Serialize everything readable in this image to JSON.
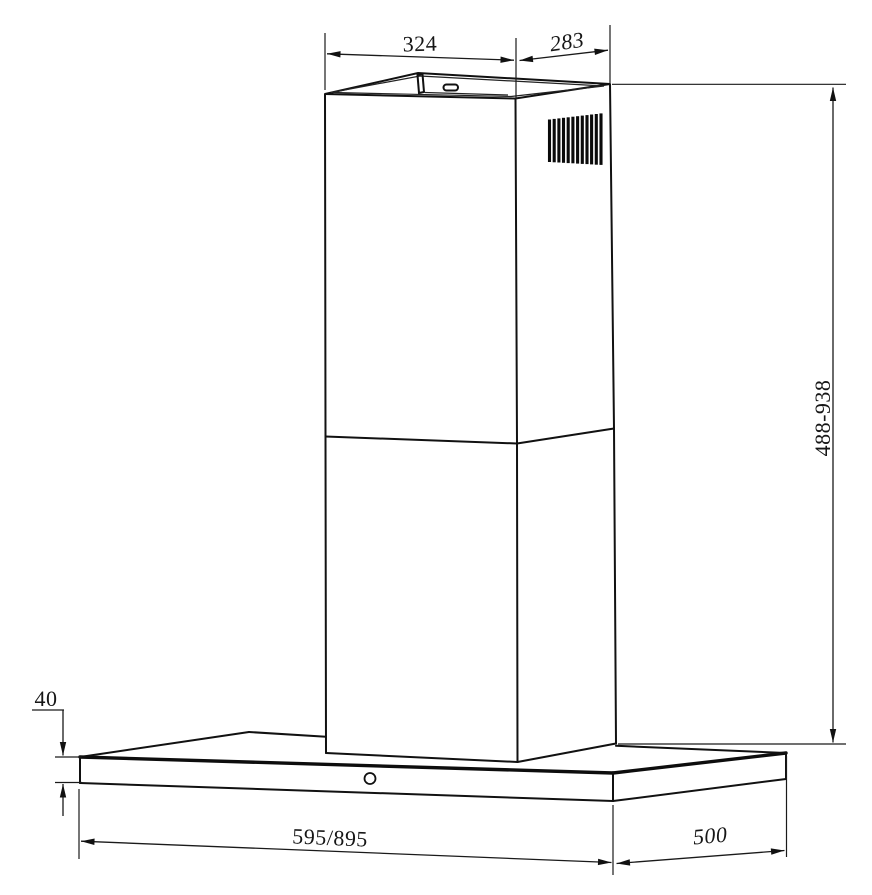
{
  "colors": {
    "line": "#111111",
    "background": "#ffffff"
  },
  "drawing": {
    "dimensions": {
      "chimney_width": "324",
      "chimney_depth": "283",
      "height_range": "488-938",
      "canopy_front_height": "40",
      "canopy_width": "595/895",
      "canopy_depth": "500"
    }
  }
}
